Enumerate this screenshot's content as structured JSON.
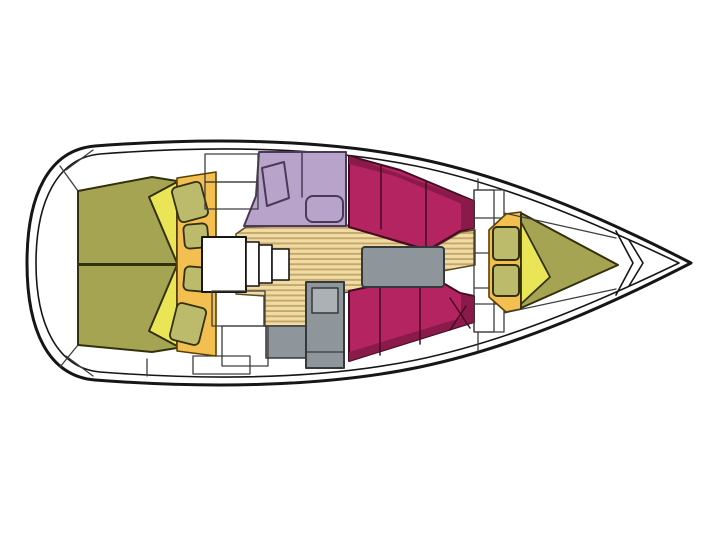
{
  "figure": {
    "type": "boat-floorplan",
    "description": "Top-down interior layout plan of a sailing yacht, bow pointing right, stern rounded at left",
    "orientation": {
      "bow": "right",
      "stern": "left"
    }
  },
  "palette": {
    "background": "#ffffff",
    "deck_white": "#ffffff",
    "hull_outline": "#161616",
    "seam_line": "#3d3d3d",
    "olive": "#a5a452",
    "olive_light": "#bcbb6b",
    "olive_stroke": "#33300e",
    "yellow": "#e9e557",
    "orange": "#f3bf50",
    "orange_stroke": "#5a4006",
    "magenta": "#b32461",
    "magenta_dark": "#8a1a49",
    "magenta_stroke": "#450b24",
    "purple": "#b8a4ca",
    "purple_stroke": "#4b3a57",
    "wood_light": "#eedca4",
    "wood_stripe": "#c7a66b",
    "wood_stroke": "#5a4a20",
    "gray": "#8f969b",
    "gray_light": "#abb1b5",
    "gray_stroke": "#35393c"
  },
  "regions": [
    {
      "id": "hull",
      "label": "hull outline",
      "fill": "deck_white"
    },
    {
      "id": "aft-berth-port",
      "label": "aft cabin berth top",
      "fill": "olive"
    },
    {
      "id": "aft-berth-starboard",
      "label": "aft cabin berth bottom",
      "fill": "olive"
    },
    {
      "id": "aft-berth-blankets",
      "label": "folded blankets on aft berths",
      "fill": "yellow"
    },
    {
      "id": "aft-shelf",
      "label": "aft shelf with cushions",
      "fill": "orange"
    },
    {
      "id": "companionway-steps",
      "label": "companionway steps",
      "fill": "deck_white"
    },
    {
      "id": "galley",
      "label": "galley with sink and stove",
      "fill": "purple"
    },
    {
      "id": "saloon-floor",
      "label": "saloon wood plank sole",
      "fill": "wood_light"
    },
    {
      "id": "saloon-table",
      "label": "saloon table",
      "fill": "gray"
    },
    {
      "id": "settee-port",
      "label": "saloon settee top",
      "fill": "magenta"
    },
    {
      "id": "settee-starboard",
      "label": "saloon settee bottom",
      "fill": "magenta"
    },
    {
      "id": "heads-door",
      "label": "heads compartment door",
      "fill": "gray"
    },
    {
      "id": "fwd-bulkhead",
      "label": "forward bulkhead lockers",
      "fill": "deck_white"
    },
    {
      "id": "v-berth",
      "label": "V-berth mattress",
      "fill": "olive"
    },
    {
      "id": "v-berth-blanket",
      "label": "folded blanket on V-berth",
      "fill": "yellow"
    },
    {
      "id": "v-berth-shelf",
      "label": "bow shelf with cushions",
      "fill": "orange"
    },
    {
      "id": "bow-chevrons",
      "label": "anchor locker deck seams",
      "fill": "deck_white"
    }
  ]
}
